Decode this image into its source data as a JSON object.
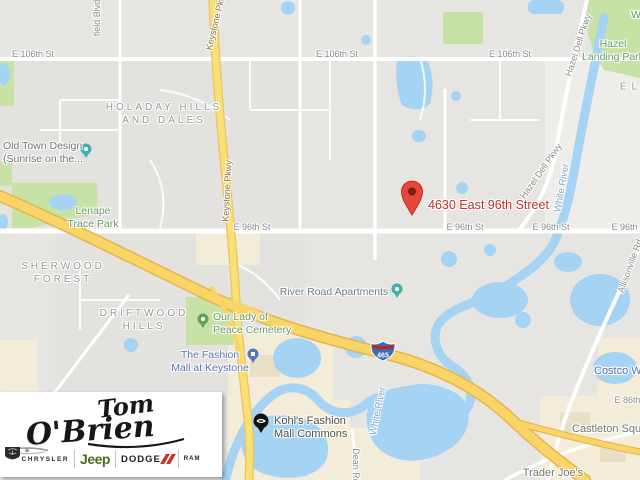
{
  "map": {
    "marker": {
      "address": "4630 East 96th Street"
    },
    "interstate_shield": {
      "number": "465"
    },
    "streets": {
      "e_106th": "E 106th St",
      "e_96th": "E 96th St",
      "e_86th": "E 86th St",
      "field_blvd": "field Blvd",
      "keystone_pkwy": "Keystone Pkwy",
      "hazel_dell_pkwy": "Hazel Dell Pkwy",
      "allisonville_rd": "Allisonville Rd",
      "dean_rd": "Dean Rd",
      "white_river": "White River"
    },
    "neighborhoods": {
      "holaday_line1": "Holaday Hills",
      "holaday_line2": "and Dales",
      "sherwood_line1": "Sherwood",
      "sherwood_line2": "Forest",
      "driftwood_line1": "Driftwood",
      "driftwood_line2": "Hills",
      "el_partial": "EL"
    },
    "parks": {
      "hazel_landing_line1": "Hazel",
      "hazel_landing_line2": "Landing Park",
      "lenape_line1": "Lenape",
      "lenape_line2": "Trace Park",
      "our_lady_line1": "Our Lady of",
      "our_lady_line2": "Peace Cemetery",
      "corner_partial": "W"
    },
    "places": {
      "old_town_line1": "Old Town Design",
      "old_town_line2": "(Sunrise on the...",
      "river_road": "River Road Apartments",
      "fashion_mall_line1": "The Fashion",
      "fashion_mall_line2": "Mall at Keystone",
      "kohls_line1": "Kohl's Fashion",
      "kohls_line2": "Mall Commons",
      "castleton": "Castleton Square",
      "trader_joes": "Trader Joe's",
      "costco": "Costco Wholesale"
    },
    "colors": {
      "marker_red": "#bb352b",
      "road_yellow": "#f9d466",
      "water_blue": "#a5d3f4",
      "park_green": "#c7e2a5",
      "poi_blue": "#5873b7",
      "poi_green": "#689c61"
    }
  },
  "dealer_logo": {
    "script_line1": "Tom",
    "script_line2": "O'Brien",
    "chrysler": "CHRYSLER",
    "jeep": "Jeep",
    "dodge": "DODGE",
    "ram": "RAM"
  }
}
